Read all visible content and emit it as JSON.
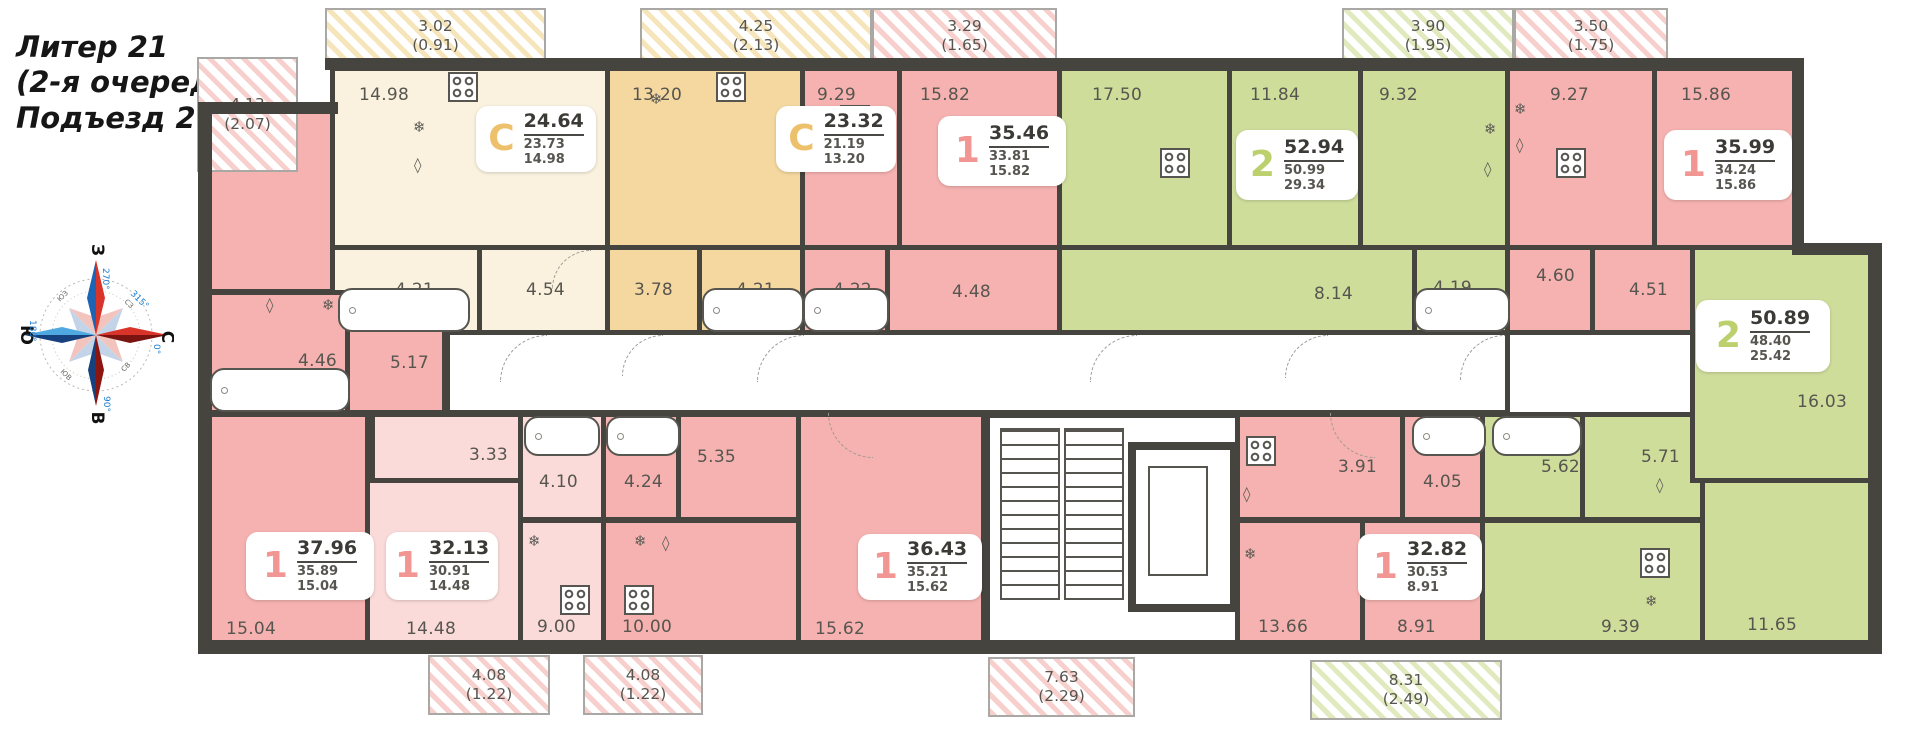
{
  "title": {
    "lines": [
      "Литер 21",
      "(2-я очередь)",
      "Подъезд 2"
    ]
  },
  "compass": {
    "west": "З",
    "north": "С",
    "east": "В",
    "south": "Ю",
    "deg_top": "270°",
    "deg_right": "0°",
    "deg_bottom": "90°",
    "deg_left": "180°",
    "deg_diag": "315°",
    "inter": [
      "СЗ",
      "СВ",
      "ЮЗ",
      "ЮВ"
    ]
  },
  "palette": {
    "wall": "#45443f",
    "text": "#56554f",
    "room_pink": "#f6b2b0",
    "room_pink_light": "#fbdbda",
    "room_cream": "#faf2df",
    "room_tan": "#f5d8a0",
    "room_green": "#cfdd9b",
    "accent_gold": "#edc06c",
    "accent_salmon": "#f29693",
    "accent_green": "#bdd06e"
  },
  "balconies": [
    {
      "area": "4.13",
      "coeff": "(2.07)",
      "hatch": "pink",
      "x": 197,
      "y": 57,
      "w": 101,
      "h": 115
    },
    {
      "area": "3.02",
      "coeff": "(0.91)",
      "hatch": "yellow",
      "x": 325,
      "y": 8,
      "w": 221,
      "h": 56
    },
    {
      "area": "4.25",
      "coeff": "(2.13)",
      "hatch": "yellow",
      "x": 640,
      "y": 8,
      "w": 232,
      "h": 56
    },
    {
      "area": "3.29",
      "coeff": "(1.65)",
      "hatch": "pink",
      "x": 872,
      "y": 8,
      "w": 185,
      "h": 56
    },
    {
      "area": "3.90",
      "coeff": "(1.95)",
      "hatch": "green",
      "x": 1342,
      "y": 8,
      "w": 172,
      "h": 56
    },
    {
      "area": "3.50",
      "coeff": "(1.75)",
      "hatch": "pink",
      "x": 1514,
      "y": 8,
      "w": 154,
      "h": 56
    },
    {
      "area": "4.08",
      "coeff": "(1.22)",
      "hatch": "pink",
      "x": 428,
      "y": 655,
      "w": 122,
      "h": 60
    },
    {
      "area": "4.08",
      "coeff": "(1.22)",
      "hatch": "pink",
      "x": 583,
      "y": 655,
      "w": 120,
      "h": 60
    },
    {
      "area": "7.63",
      "coeff": "(2.29)",
      "hatch": "pink",
      "x": 988,
      "y": 657,
      "w": 147,
      "h": 60
    },
    {
      "area": "8.31",
      "coeff": "(2.49)",
      "hatch": "green",
      "x": 1310,
      "y": 660,
      "w": 192,
      "h": 60
    }
  ],
  "apartments": [
    {
      "type": "С",
      "total": "24.64",
      "living": "23.73",
      "kitchen": "14.98",
      "accent": "gold",
      "x": 476,
      "y": 106,
      "w": 120,
      "h": 66
    },
    {
      "type": "С",
      "total": "23.32",
      "living": "21.19",
      "kitchen": "13.20",
      "accent": "gold",
      "x": 776,
      "y": 106,
      "w": 120,
      "h": 66
    },
    {
      "type": "1",
      "total": "35.46",
      "living": "33.81",
      "kitchen": "15.82",
      "accent": "salmon",
      "x": 938,
      "y": 116,
      "w": 128,
      "h": 70
    },
    {
      "type": "2",
      "total": "52.94",
      "living": "50.99",
      "kitchen": "29.34",
      "accent": "green",
      "x": 1236,
      "y": 130,
      "w": 122,
      "h": 70
    },
    {
      "type": "1",
      "total": "35.99",
      "living": "34.24",
      "kitchen": "15.86",
      "accent": "salmon",
      "x": 1664,
      "y": 130,
      "w": 128,
      "h": 70
    },
    {
      "type": "1",
      "total": "37.96",
      "living": "35.89",
      "kitchen": "15.04",
      "accent": "salmon",
      "x": 246,
      "y": 532,
      "w": 128,
      "h": 68
    },
    {
      "type": "1",
      "total": "32.13",
      "living": "30.91",
      "kitchen": "14.48",
      "accent": "salmon",
      "x": 386,
      "y": 532,
      "w": 112,
      "h": 68
    },
    {
      "type": "1",
      "total": "36.43",
      "living": "35.21",
      "kitchen": "15.62",
      "accent": "salmon",
      "x": 858,
      "y": 534,
      "w": 124,
      "h": 66
    },
    {
      "type": "1",
      "total": "32.82",
      "living": "30.53",
      "kitchen": "8.91",
      "accent": "salmon",
      "x": 1358,
      "y": 534,
      "w": 124,
      "h": 66
    },
    {
      "type": "2",
      "total": "50.89",
      "living": "48.40",
      "kitchen": "25.42",
      "accent": "green",
      "x": 1696,
      "y": 300,
      "w": 134,
      "h": 72
    }
  ],
  "rooms": [
    {
      "area": "11.22",
      "fill": "pink",
      "x": 205,
      "y": 106,
      "w": 130,
      "h": 188,
      "lx": 16,
      "ly": 12
    },
    {
      "area": "14.98",
      "fill": "cream",
      "x": 330,
      "y": 66,
      "w": 280,
      "h": 184,
      "lx": 24,
      "ly": 14
    },
    {
      "area": "4.21",
      "fill": "cream",
      "x": 330,
      "y": 245,
      "w": 152,
      "h": 90,
      "lx": 60,
      "ly": 30
    },
    {
      "area": "4.54",
      "fill": "cream",
      "x": 477,
      "y": 245,
      "w": 133,
      "h": 90,
      "lx": 44,
      "ly": 30
    },
    {
      "area": "13.20",
      "fill": "tan",
      "x": 605,
      "y": 66,
      "w": 200,
      "h": 184,
      "lx": 22,
      "ly": 14
    },
    {
      "area": "3.78",
      "fill": "tan",
      "x": 605,
      "y": 245,
      "w": 97,
      "h": 90,
      "lx": 24,
      "ly": 30
    },
    {
      "area": "4.21",
      "fill": "tan",
      "x": 697,
      "y": 245,
      "w": 108,
      "h": 90,
      "lx": 34,
      "ly": 30
    },
    {
      "area": "9.29",
      "fill": "pink",
      "x": 800,
      "y": 66,
      "w": 102,
      "h": 184,
      "lx": 12,
      "ly": 14
    },
    {
      "area": "15.82",
      "fill": "pink",
      "x": 897,
      "y": 66,
      "w": 165,
      "h": 184,
      "lx": 18,
      "ly": 14
    },
    {
      "area": "4.22",
      "fill": "pink",
      "x": 800,
      "y": 245,
      "w": 90,
      "h": 90,
      "lx": 28,
      "ly": 30
    },
    {
      "area": "4.48",
      "fill": "pink",
      "x": 885,
      "y": 245,
      "w": 177,
      "h": 90,
      "lx": 62,
      "ly": 32
    },
    {
      "area": "17.50",
      "fill": "green",
      "x": 1057,
      "y": 66,
      "w": 175,
      "h": 184,
      "lx": 30,
      "ly": 14
    },
    {
      "area": "11.84",
      "fill": "green",
      "x": 1227,
      "y": 66,
      "w": 136,
      "h": 184,
      "lx": 18,
      "ly": 14
    },
    {
      "area": "9.32",
      "fill": "green",
      "x": 1358,
      "y": 66,
      "w": 152,
      "h": 184,
      "lx": 16,
      "ly": 14
    },
    {
      "area": "8.14",
      "fill": "green",
      "x": 1057,
      "y": 245,
      "w": 360,
      "h": 90,
      "lx": 252,
      "ly": 34
    },
    {
      "area": "4.19",
      "fill": "green",
      "x": 1412,
      "y": 245,
      "w": 98,
      "h": 90,
      "lx": 16,
      "ly": 28
    },
    {
      "area": "9.27",
      "fill": "pink",
      "x": 1505,
      "y": 66,
      "w": 152,
      "h": 184,
      "lx": 40,
      "ly": 14
    },
    {
      "area": "15.86",
      "fill": "pink",
      "x": 1652,
      "y": 66,
      "w": 150,
      "h": 269,
      "lx": 24,
      "ly": 14
    },
    {
      "area": "4.60",
      "fill": "pink",
      "x": 1505,
      "y": 245,
      "w": 90,
      "h": 90,
      "lx": 26,
      "ly": 16
    },
    {
      "area": "4.51",
      "fill": "pink",
      "x": 1590,
      "y": 245,
      "w": 117,
      "h": 90,
      "lx": 34,
      "ly": 30
    },
    {
      "area": "",
      "fill": "white",
      "x": 445,
      "y": 330,
      "w": 1065,
      "h": 85,
      "lx": 0,
      "ly": 0
    },
    {
      "area": "",
      "fill": "white",
      "x": 985,
      "y": 413,
      "w": 255,
      "h": 234,
      "lx": 0,
      "ly": 0
    },
    {
      "area": "4.46",
      "fill": "pink",
      "x": 205,
      "y": 290,
      "w": 145,
      "h": 125,
      "lx": 88,
      "ly": 56
    },
    {
      "area": "5.17",
      "fill": "pink",
      "x": 345,
      "y": 290,
      "w": 102,
      "h": 125,
      "lx": 40,
      "ly": 58
    },
    {
      "area": "15.04",
      "fill": "pink",
      "x": 205,
      "y": 412,
      "w": 165,
      "h": 235,
      "lx": 16,
      "ly": 202
    },
    {
      "area": "3.33",
      "fill": "pinklight",
      "x": 370,
      "y": 412,
      "w": 153,
      "h": 72,
      "lx": 94,
      "ly": 28
    },
    {
      "area": "4.10",
      "fill": "pinklight",
      "x": 518,
      "y": 412,
      "w": 88,
      "h": 110,
      "lx": 16,
      "ly": 55
    },
    {
      "area": "14.48",
      "fill": "pinklight",
      "x": 365,
      "y": 478,
      "w": 158,
      "h": 169,
      "lx": 36,
      "ly": 136
    },
    {
      "area": "9.00",
      "fill": "pinklight",
      "x": 518,
      "y": 518,
      "w": 88,
      "h": 129,
      "lx": 14,
      "ly": 94
    },
    {
      "area": "4.24",
      "fill": "pink",
      "x": 601,
      "y": 412,
      "w": 80,
      "h": 110,
      "lx": 18,
      "ly": 55
    },
    {
      "area": "5.35",
      "fill": "pink",
      "x": 676,
      "y": 412,
      "w": 125,
      "h": 110,
      "lx": 16,
      "ly": 30
    },
    {
      "area": "10.00",
      "fill": "pink",
      "x": 601,
      "y": 518,
      "w": 200,
      "h": 129,
      "lx": 16,
      "ly": 94
    },
    {
      "area": "15.62",
      "fill": "pink",
      "x": 796,
      "y": 412,
      "w": 190,
      "h": 235,
      "lx": 14,
      "ly": 202
    },
    {
      "area": "3.91",
      "fill": "pink",
      "x": 1235,
      "y": 412,
      "w": 170,
      "h": 110,
      "lx": 98,
      "ly": 40
    },
    {
      "area": "4.05",
      "fill": "pink",
      "x": 1400,
      "y": 412,
      "w": 85,
      "h": 110,
      "lx": 18,
      "ly": 55
    },
    {
      "area": "13.66",
      "fill": "pink",
      "x": 1235,
      "y": 518,
      "w": 130,
      "h": 129,
      "lx": 18,
      "ly": 94
    },
    {
      "area": "8.91",
      "fill": "pink",
      "x": 1360,
      "y": 518,
      "w": 125,
      "h": 129,
      "lx": 32,
      "ly": 94
    },
    {
      "area": "5.62",
      "fill": "green",
      "x": 1480,
      "y": 412,
      "w": 105,
      "h": 110,
      "lx": 56,
      "ly": 40
    },
    {
      "area": "5.71",
      "fill": "green",
      "x": 1580,
      "y": 412,
      "w": 125,
      "h": 110,
      "lx": 56,
      "ly": 30
    },
    {
      "area": "9.39",
      "fill": "green",
      "x": 1480,
      "y": 518,
      "w": 225,
      "h": 129,
      "lx": 116,
      "ly": 94
    },
    {
      "area": "11.65",
      "fill": "green",
      "x": 1700,
      "y": 478,
      "w": 180,
      "h": 169,
      "lx": 42,
      "ly": 132
    },
    {
      "area": "16.03",
      "fill": "green",
      "x": 1690,
      "y": 245,
      "w": 190,
      "h": 238,
      "lx": 102,
      "ly": 142
    }
  ],
  "walls": [
    [
      325,
      58,
      1478,
      12
    ],
    [
      198,
      102,
      14,
      550
    ],
    [
      198,
      102,
      140,
      12
    ],
    [
      198,
      640,
      1245,
      14
    ],
    [
      1430,
      640,
      452,
      14
    ],
    [
      1792,
      58,
      12,
      192
    ],
    [
      1792,
      243,
      90,
      12
    ],
    [
      1868,
      243,
      14,
      411
    ]
  ],
  "fixtures": {
    "stoves": [
      [
        448,
        72
      ],
      [
        716,
        72
      ],
      [
        840,
        105
      ],
      [
        1160,
        148
      ],
      [
        1556,
        148
      ],
      [
        560,
        585
      ],
      [
        624,
        585
      ],
      [
        1246,
        436
      ],
      [
        1640,
        548
      ]
    ],
    "snowflakes": [
      [
        413,
        118
      ],
      [
        650,
        90
      ],
      [
        806,
        120
      ],
      [
        1484,
        120
      ],
      [
        1514,
        100
      ],
      [
        322,
        296
      ],
      [
        528,
        532
      ],
      [
        634,
        532
      ],
      [
        1244,
        545
      ],
      [
        1645,
        592
      ]
    ],
    "boilers": [
      [
        414,
        156
      ],
      [
        1484,
        160
      ],
      [
        1516,
        136
      ],
      [
        266,
        296
      ],
      [
        662,
        534
      ],
      [
        1243,
        485
      ],
      [
        1656,
        476
      ]
    ],
    "tubs": [
      [
        338,
        288,
        128,
        40
      ],
      [
        702,
        288,
        98,
        40
      ],
      [
        803,
        288,
        82,
        40
      ],
      [
        1414,
        288,
        92,
        40
      ],
      [
        210,
        368,
        136,
        40
      ],
      [
        524,
        416,
        72,
        36
      ],
      [
        606,
        416,
        70,
        36
      ],
      [
        1412,
        416,
        70,
        36
      ],
      [
        1492,
        416,
        86,
        36
      ]
    ],
    "arcs": [
      [
        500,
        335,
        46,
        "tl"
      ],
      [
        622,
        335,
        40,
        "tl"
      ],
      [
        757,
        335,
        46,
        "tl"
      ],
      [
        1090,
        335,
        46,
        "tl"
      ],
      [
        1285,
        335,
        42,
        "tl"
      ],
      [
        1460,
        335,
        44,
        "tl"
      ],
      [
        828,
        413,
        44,
        "bl"
      ],
      [
        1330,
        413,
        44,
        "bl"
      ],
      [
        552,
        250,
        38,
        "tl"
      ]
    ]
  },
  "stairs": {
    "flights": [
      [
        1000,
        428,
        56,
        168
      ],
      [
        1064,
        428,
        56,
        168
      ]
    ],
    "elevator_outer": [
      1128,
      442,
      94,
      154
    ],
    "elevator_inner": [
      1148,
      466,
      56,
      106
    ]
  }
}
